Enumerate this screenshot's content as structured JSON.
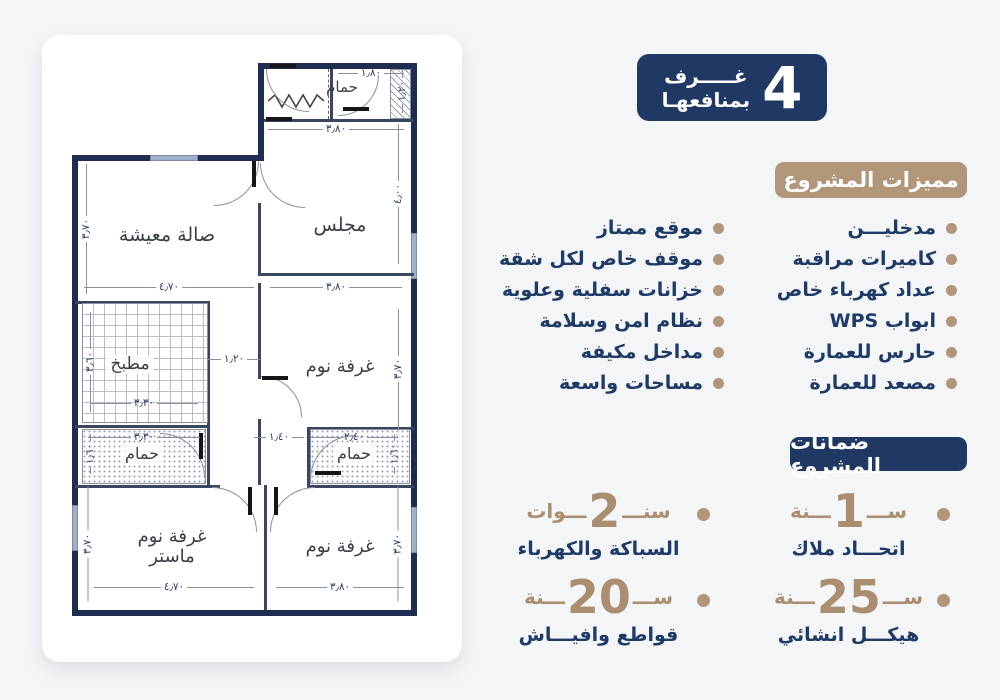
{
  "badge": {
    "number": "4",
    "line1": "غـــــرف",
    "line2": "بمنافعهـا"
  },
  "features": {
    "title": "مميزات المشروع",
    "right": [
      "مدخليـــن",
      "كاميرات مراقبة",
      "عداد كهرباء خاص",
      "ابواب WPS",
      "حارس للعمارة",
      "مصعد للعمارة"
    ],
    "left": [
      "موقع ممتاز",
      "موقف خاص لكل شقة",
      "خزانات سفلية وعلوية",
      "نظام امن وسلامة",
      "مداخل مكيفة",
      "مساحات واسعة"
    ]
  },
  "guarantees": {
    "title": "ضمانات المشروع",
    "items": [
      {
        "prefix": "ســـ",
        "number": "1",
        "suffix": "ـــنة",
        "label": "اتحـــاد ملاك"
      },
      {
        "prefix": "سنـــ",
        "number": "2",
        "suffix": "ـــوات",
        "label": "السباكة والكهرباء"
      },
      {
        "prefix": "ســـ",
        "number": "25",
        "suffix": "ـــنة",
        "label": "هيكـــل انشائي"
      },
      {
        "prefix": "ســـ",
        "number": "20",
        "suffix": "ـــنة",
        "label": "قواطع وافيـــاش"
      }
    ]
  },
  "plan": {
    "rooms": {
      "bath_top": {
        "label": "حمام",
        "w": "١٫٨٠",
        "h": "١٫٢٠"
      },
      "majlis": {
        "label": "مجلس",
        "w": "٣٫٨٠",
        "h": "٤٫٠٠"
      },
      "living": {
        "label": "صالة معيشة",
        "w": "٤٫٧٠",
        "h": "٣٫٧٠"
      },
      "kitchen": {
        "label": "مطبخ",
        "w": "٣٫٣٠",
        "h": "٣٫٦٠"
      },
      "bed_top": {
        "label": "غرفة نوم",
        "w": "٣٫٨٠",
        "h": "٣٫٧٠"
      },
      "bath_left": {
        "label": "حمام",
        "w": "٣٫٣٠",
        "h": "١٫٦٠"
      },
      "bath_right": {
        "label": "حمام",
        "w": "٢٫٤٠",
        "h": "١٫٦٠"
      },
      "bed_master": {
        "label1": "غرفة نوم",
        "label2": "ماستر",
        "w": "٤٫٧٠",
        "h": "٣٫٧٠"
      },
      "bed_bottom": {
        "label": "غرفة نوم",
        "w": "٣٫٨٠",
        "h": "٣٫٧٠"
      },
      "hall_w": "١٫٢٠",
      "corridor_w": "١٫٤٠"
    }
  },
  "colors": {
    "navy": "#203864",
    "tan": "#b2967a",
    "text_navy": "#1e3a66",
    "wall_navy": "#1d2c50"
  }
}
